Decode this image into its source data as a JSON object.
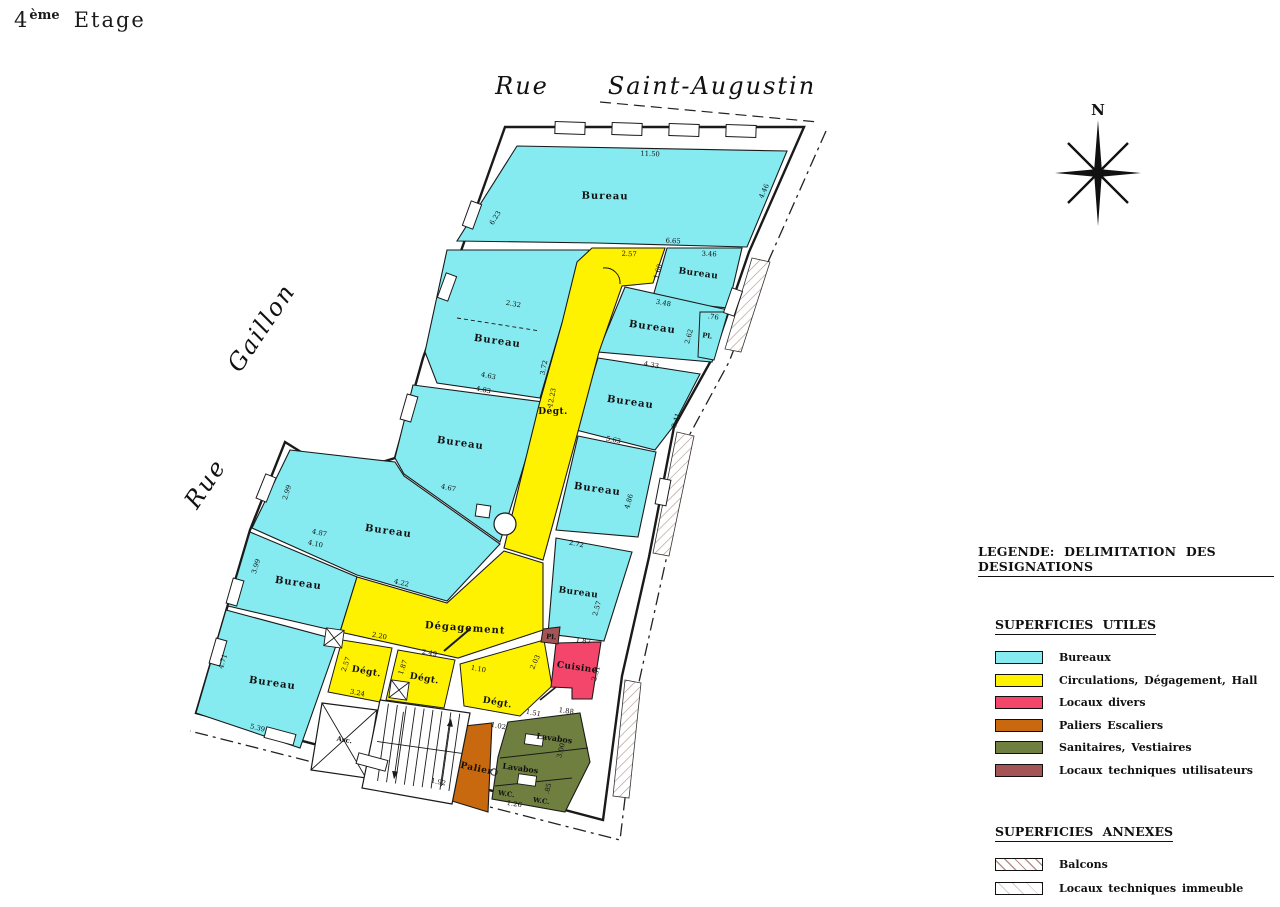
{
  "page": {
    "title_num": "4",
    "title_sup": "ème",
    "title_word": "Etage"
  },
  "streets": {
    "rue_top": "Rue",
    "name_top": "Saint-Augustin",
    "rue_left": "Rue",
    "name_left": "Gaillon"
  },
  "compass": {
    "label": "N"
  },
  "legend": {
    "title": "LEGENDE: DELIMITATION DES DESIGNATIONS",
    "sections": [
      {
        "heading": "SUPERFICIES UTILES",
        "items": [
          {
            "label": "Bureaux",
            "color": "#86EBF1"
          },
          {
            "label": "Circulations, Dégagement, Hall",
            "color": "#FFF200"
          },
          {
            "label": "Locaux divers",
            "color": "#F4456B"
          },
          {
            "label": "Paliers Escaliers",
            "color": "#C8690F"
          },
          {
            "label": "Sanitaires, Vestiaires",
            "color": "#6F7F3F"
          },
          {
            "label": "Locaux techniques utilisateurs",
            "color": "#A45454"
          }
        ]
      },
      {
        "heading": "SUPERFICIES ANNEXES",
        "items": [
          {
            "label": "Balcons"
          },
          {
            "label": "Locaux techniques immeuble"
          }
        ]
      }
    ]
  },
  "plan": {
    "rooms": [
      "Bureau",
      "Bureau",
      "Bureau",
      "Bureau",
      "Bureau",
      "Bureau",
      "Bureau",
      "Bureau",
      "Pl.",
      "Bureau",
      "Bureau",
      "Bureau",
      "Dégt.",
      "Dégagement",
      "Dégt.",
      "Dégt.",
      "Dégt.",
      "Cuisine",
      "Pl.",
      "Asc.",
      "Palier",
      "Lavabos",
      "Lavabos",
      "W.C.",
      "W.C."
    ],
    "dims": [
      "11.50",
      "4.46",
      "6.23",
      "6.65",
      "2.57",
      "3.46",
      "1.60",
      "2.32",
      "3.48",
      ".76",
      "2.62",
      "3.72",
      "12.23",
      "4.63",
      "4.83",
      "4.33",
      "3.41",
      "5.63",
      "4.67",
      "2.99",
      "4.86",
      "4.87",
      "4.10",
      "3.99",
      "2.72",
      "4.22",
      "2.57",
      "2.20",
      "2.49",
      "2.57",
      "1.87",
      "3.24",
      "1.10",
      "2.03",
      "1.87",
      "2.31",
      "1.51",
      "1.02",
      "1.88",
      "3.00",
      "4.71",
      "5.39",
      "1.92",
      ".85",
      "1.26"
    ]
  }
}
